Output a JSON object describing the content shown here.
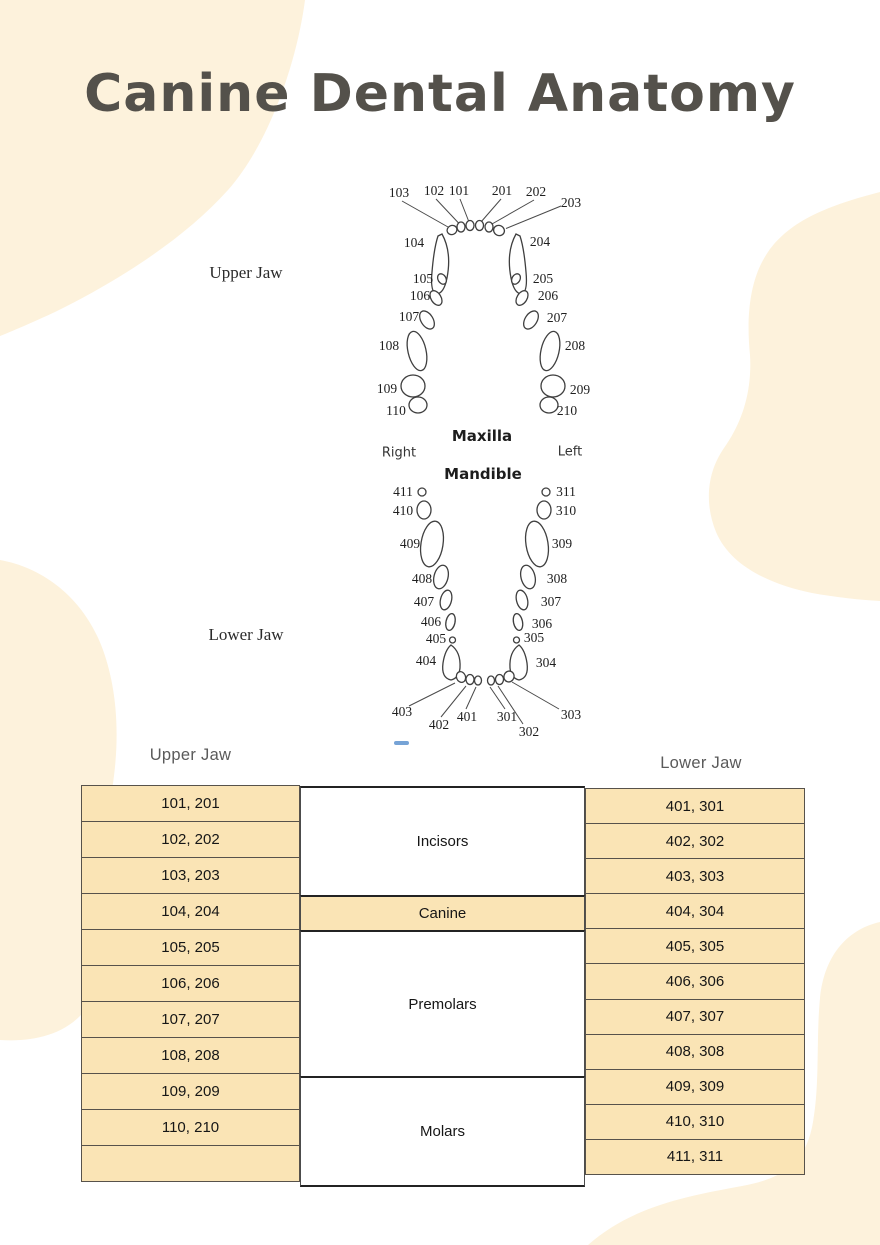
{
  "title": "Canine Dental Anatomy",
  "colors": {
    "blob": "#fdf2dc",
    "cell": "#fae4b5",
    "title_text": "#54514b",
    "accent_dash": "#76a3d6"
  },
  "diagram": {
    "labels": [
      {
        "text": "Upper Jaw",
        "x": 246,
        "y": 273,
        "kind": "jaw"
      },
      {
        "text": "Lower Jaw",
        "x": 246,
        "y": 635,
        "kind": "jaw"
      },
      {
        "text": "Maxilla",
        "x": 482,
        "y": 436,
        "kind": "bone"
      },
      {
        "text": "Mandible",
        "x": 483,
        "y": 474,
        "kind": "bone"
      },
      {
        "text": "Right",
        "x": 399,
        "y": 453,
        "kind": "side"
      },
      {
        "text": "Left",
        "x": 570,
        "y": 452,
        "kind": "side"
      },
      {
        "text": "103",
        "x": 399,
        "y": 193,
        "kind": "num"
      },
      {
        "text": "102",
        "x": 434,
        "y": 191,
        "kind": "num"
      },
      {
        "text": "101",
        "x": 459,
        "y": 191,
        "kind": "num"
      },
      {
        "text": "201",
        "x": 502,
        "y": 191,
        "kind": "num"
      },
      {
        "text": "202",
        "x": 536,
        "y": 192,
        "kind": "num"
      },
      {
        "text": "203",
        "x": 571,
        "y": 203,
        "kind": "num"
      },
      {
        "text": "104",
        "x": 414,
        "y": 243,
        "kind": "num"
      },
      {
        "text": "204",
        "x": 540,
        "y": 242,
        "kind": "num"
      },
      {
        "text": "105",
        "x": 423,
        "y": 279,
        "kind": "num"
      },
      {
        "text": "205",
        "x": 543,
        "y": 279,
        "kind": "num"
      },
      {
        "text": "106",
        "x": 420,
        "y": 296,
        "kind": "num"
      },
      {
        "text": "206",
        "x": 548,
        "y": 296,
        "kind": "num"
      },
      {
        "text": "107",
        "x": 409,
        "y": 317,
        "kind": "num"
      },
      {
        "text": "207",
        "x": 557,
        "y": 318,
        "kind": "num"
      },
      {
        "text": "108",
        "x": 389,
        "y": 346,
        "kind": "num"
      },
      {
        "text": "208",
        "x": 575,
        "y": 346,
        "kind": "num"
      },
      {
        "text": "109",
        "x": 387,
        "y": 389,
        "kind": "num"
      },
      {
        "text": "209",
        "x": 580,
        "y": 390,
        "kind": "num"
      },
      {
        "text": "110",
        "x": 396,
        "y": 411,
        "kind": "num"
      },
      {
        "text": "210",
        "x": 567,
        "y": 411,
        "kind": "num"
      },
      {
        "text": "411",
        "x": 403,
        "y": 492,
        "kind": "num"
      },
      {
        "text": "311",
        "x": 566,
        "y": 492,
        "kind": "num"
      },
      {
        "text": "410",
        "x": 403,
        "y": 511,
        "kind": "num"
      },
      {
        "text": "310",
        "x": 566,
        "y": 511,
        "kind": "num"
      },
      {
        "text": "409",
        "x": 410,
        "y": 544,
        "kind": "num"
      },
      {
        "text": "309",
        "x": 562,
        "y": 544,
        "kind": "num"
      },
      {
        "text": "408",
        "x": 422,
        "y": 579,
        "kind": "num"
      },
      {
        "text": "308",
        "x": 557,
        "y": 579,
        "kind": "num"
      },
      {
        "text": "407",
        "x": 424,
        "y": 602,
        "kind": "num"
      },
      {
        "text": "307",
        "x": 551,
        "y": 602,
        "kind": "num"
      },
      {
        "text": "406",
        "x": 431,
        "y": 622,
        "kind": "num"
      },
      {
        "text": "306",
        "x": 542,
        "y": 624,
        "kind": "num"
      },
      {
        "text": "405",
        "x": 436,
        "y": 639,
        "kind": "num"
      },
      {
        "text": "305",
        "x": 534,
        "y": 638,
        "kind": "num"
      },
      {
        "text": "404",
        "x": 426,
        "y": 661,
        "kind": "num"
      },
      {
        "text": "304",
        "x": 546,
        "y": 663,
        "kind": "num"
      },
      {
        "text": "403",
        "x": 402,
        "y": 712,
        "kind": "num"
      },
      {
        "text": "303",
        "x": 571,
        "y": 715,
        "kind": "num"
      },
      {
        "text": "402",
        "x": 439,
        "y": 725,
        "kind": "num"
      },
      {
        "text": "302",
        "x": 529,
        "y": 732,
        "kind": "num"
      },
      {
        "text": "401",
        "x": 467,
        "y": 717,
        "kind": "num"
      },
      {
        "text": "301",
        "x": 507,
        "y": 717,
        "kind": "num"
      }
    ]
  },
  "table": {
    "upper_header": "Upper Jaw",
    "lower_header": "Lower Jaw",
    "upper_rows": [
      "101, 201",
      "102, 202",
      "103, 203",
      "104, 204",
      "105, 205",
      "106, 206",
      "107, 207",
      "108, 208",
      "109, 209",
      "110, 210",
      ""
    ],
    "lower_rows": [
      "401, 301",
      "402, 302",
      "403, 303",
      "404, 304",
      "405, 305",
      "406, 306",
      "407, 307",
      "408, 308",
      "409, 309",
      "410, 310",
      "411, 311"
    ],
    "categories": [
      {
        "label": "Incisors",
        "rows": 3,
        "highlight": false
      },
      {
        "label": "Canine",
        "rows": 1,
        "highlight": true
      },
      {
        "label": "Premolars",
        "rows": 4,
        "highlight": false
      },
      {
        "label": "Molars",
        "rows": 3,
        "highlight": false
      }
    ]
  }
}
